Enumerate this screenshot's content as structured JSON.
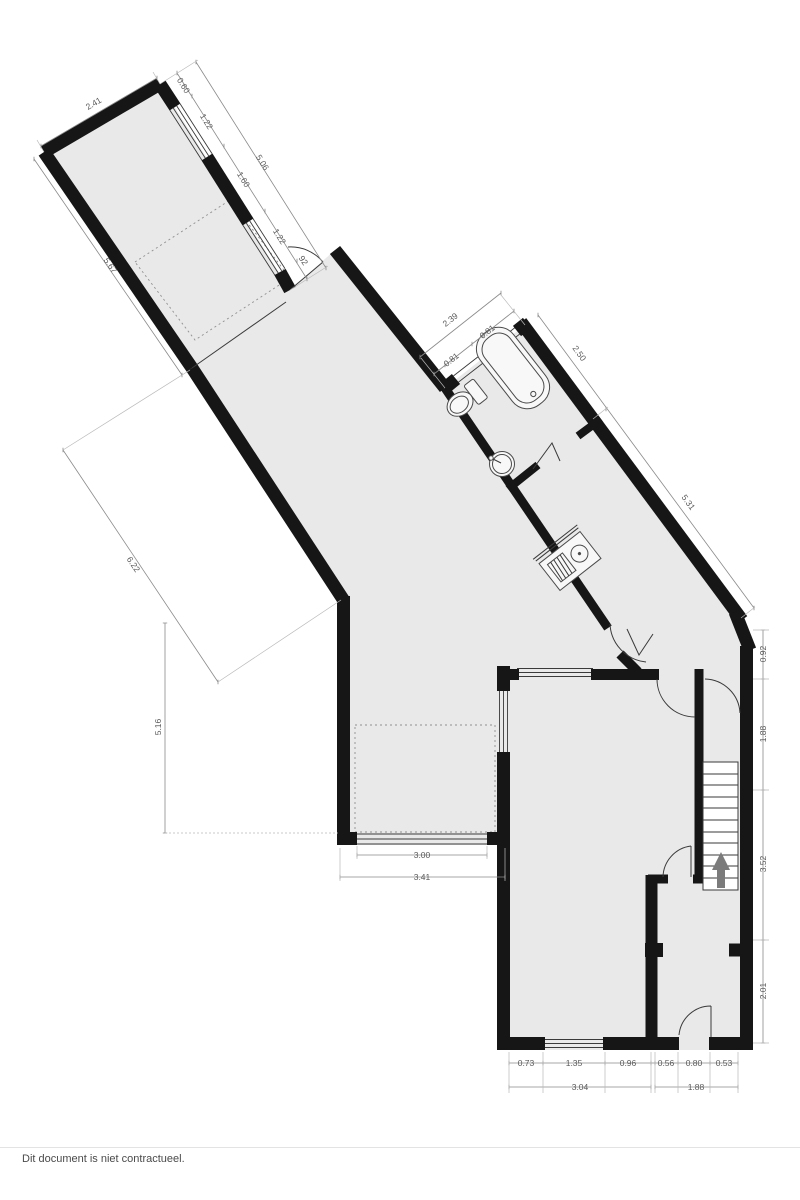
{
  "footer": {
    "note": "Dit document is niet contractueel."
  },
  "icons": [
    "bathtub",
    "toilet",
    "washbasin",
    "kitchen-sink",
    "staircase",
    "stair-up-arrow",
    "door-swing-arc"
  ],
  "colors": {
    "wall": "#161616",
    "floor": "#e9e9e9",
    "dimension_text": "#5a5a5a",
    "stair_arrow": "#7b7b7b"
  },
  "dimensions": [
    {
      "label": "2.41",
      "x": 95,
      "y": 106,
      "rot": -30
    },
    {
      "label": "0.60",
      "x": 181,
      "y": 87,
      "rot": 58
    },
    {
      "label": "1.22",
      "x": 204,
      "y": 123,
      "rot": 58
    },
    {
      "label": "1.60",
      "x": 241,
      "y": 181,
      "rot": 58
    },
    {
      "label": "1.22",
      "x": 277,
      "y": 238,
      "rot": 58
    },
    {
      "label": "5.06",
      "x": 260,
      "y": 164,
      "rot": 58
    },
    {
      "label": "5.67",
      "x": 108,
      "y": 267,
      "rot": 55
    },
    {
      "label": "92",
      "x": 301,
      "y": 262,
      "rot": 56
    },
    {
      "label": "2.39",
      "x": 452,
      "y": 322,
      "rot": -38
    },
    {
      "label": "0.81",
      "x": 453,
      "y": 362,
      "rot": -38
    },
    {
      "label": "0.81",
      "x": 489,
      "y": 334,
      "rot": -38
    },
    {
      "label": "2.50",
      "x": 577,
      "y": 355,
      "rot": 54
    },
    {
      "label": "5.31",
      "x": 686,
      "y": 504,
      "rot": 54
    },
    {
      "label": "0.92",
      "x": 766,
      "y": 654,
      "rot": -90
    },
    {
      "label": "1.88",
      "x": 766,
      "y": 734,
      "rot": -90
    },
    {
      "label": "3.52",
      "x": 766,
      "y": 864,
      "rot": -90
    },
    {
      "label": "2.01",
      "x": 766,
      "y": 991,
      "rot": -90
    },
    {
      "label": "6.22",
      "x": 131,
      "y": 566,
      "rot": 56
    },
    {
      "label": "5.16",
      "x": 161,
      "y": 727,
      "rot": -90
    },
    {
      "label": "3.00",
      "x": 422,
      "y": 858,
      "rot": 0
    },
    {
      "label": "3.41",
      "x": 422,
      "y": 880,
      "rot": 0
    },
    {
      "label": "0.73",
      "x": 526,
      "y": 1066,
      "rot": 0
    },
    {
      "label": "1.35",
      "x": 574,
      "y": 1066,
      "rot": 0
    },
    {
      "label": "0.96",
      "x": 628,
      "y": 1066,
      "rot": 0
    },
    {
      "label": "0.56",
      "x": 666,
      "y": 1066,
      "rot": 0
    },
    {
      "label": "0.80",
      "x": 694,
      "y": 1066,
      "rot": 0
    },
    {
      "label": "0.53",
      "x": 724,
      "y": 1066,
      "rot": 0
    },
    {
      "label": "3.04",
      "x": 580,
      "y": 1090,
      "rot": 0
    },
    {
      "label": "1.88",
      "x": 696,
      "y": 1090,
      "rot": 0
    }
  ]
}
